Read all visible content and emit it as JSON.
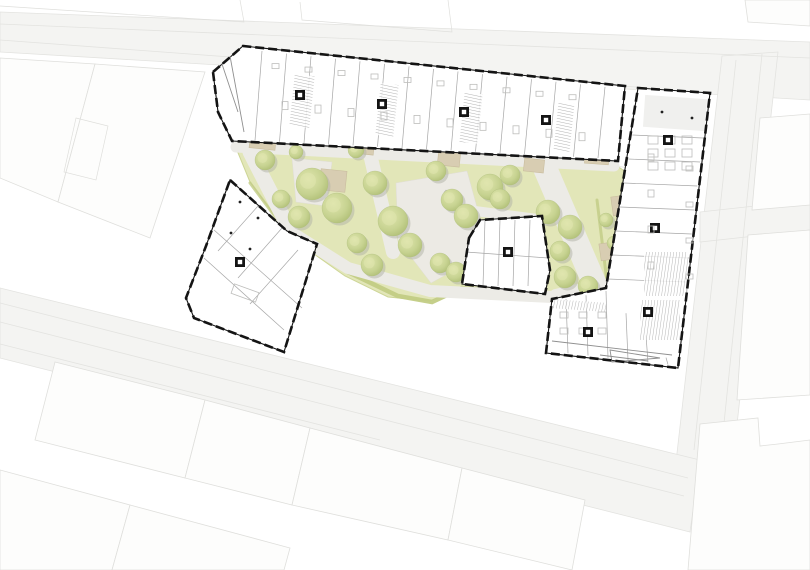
{
  "app": {
    "type": "architectural-site-plan",
    "description": "Ground-floor site plan of a perimeter housing block with green courtyard, trees and surrounding streets",
    "visible_text_labels": []
  },
  "palette": {
    "street_fill": "#f4f4f2",
    "street_line": "#e3e3e0",
    "context_fill": "#fdfdfc",
    "context_line": "#dfdfdc",
    "green_fill": "#e2e6b8",
    "green_rim": "#cdd596",
    "green_edge": "#c2cc84",
    "path_fill": "#ecebe6",
    "plaza_fill": "#eceae4",
    "terrace_fill": "#d8cdb2",
    "terrace_line": "#c9bd9e",
    "tree_light": "#e0e6ae",
    "tree_mid": "#c3d08b",
    "tree_dark": "#aebd74",
    "tree_shadow": "#b0b2a6",
    "wall": "#141414"
  },
  "site": {
    "trees": [
      {
        "x": 265,
        "y": 160,
        "r": 10
      },
      {
        "x": 296,
        "y": 152,
        "r": 7
      },
      {
        "x": 312,
        "y": 184,
        "r": 16
      },
      {
        "x": 337,
        "y": 208,
        "r": 15
      },
      {
        "x": 299,
        "y": 217,
        "r": 11
      },
      {
        "x": 281,
        "y": 199,
        "r": 9
      },
      {
        "x": 356,
        "y": 150,
        "r": 8
      },
      {
        "x": 375,
        "y": 183,
        "r": 12
      },
      {
        "x": 393,
        "y": 221,
        "r": 15
      },
      {
        "x": 410,
        "y": 245,
        "r": 12
      },
      {
        "x": 357,
        "y": 243,
        "r": 10
      },
      {
        "x": 372,
        "y": 265,
        "r": 11
      },
      {
        "x": 436,
        "y": 171,
        "r": 10
      },
      {
        "x": 452,
        "y": 200,
        "r": 11
      },
      {
        "x": 466,
        "y": 216,
        "r": 12
      },
      {
        "x": 440,
        "y": 263,
        "r": 10
      },
      {
        "x": 456,
        "y": 272,
        "r": 10
      },
      {
        "x": 490,
        "y": 187,
        "r": 13
      },
      {
        "x": 510,
        "y": 175,
        "r": 10
      },
      {
        "x": 500,
        "y": 199,
        "r": 10
      },
      {
        "x": 548,
        "y": 212,
        "r": 12
      },
      {
        "x": 570,
        "y": 227,
        "r": 12
      },
      {
        "x": 560,
        "y": 251,
        "r": 10
      },
      {
        "x": 565,
        "y": 277,
        "r": 11
      },
      {
        "x": 588,
        "y": 286,
        "r": 10
      },
      {
        "x": 614,
        "y": 243,
        "r": 7
      },
      {
        "x": 606,
        "y": 220,
        "r": 7
      }
    ],
    "terraces": [
      {
        "x": 250,
        "y": 130,
        "w": 26,
        "h": 19,
        "a": 6
      },
      {
        "x": 320,
        "y": 170,
        "w": 26,
        "h": 21,
        "a": 6
      },
      {
        "x": 352,
        "y": 139,
        "w": 22,
        "h": 15,
        "a": 6
      },
      {
        "x": 438,
        "y": 151,
        "w": 22,
        "h": 15,
        "a": 6
      },
      {
        "x": 524,
        "y": 159,
        "w": 20,
        "h": 13,
        "a": 6
      },
      {
        "x": 585,
        "y": 147,
        "w": 24,
        "h": 17,
        "a": 4
      },
      {
        "x": 612,
        "y": 196,
        "w": 15,
        "h": 19,
        "a": -8
      },
      {
        "x": 600,
        "y": 243,
        "w": 13,
        "h": 17,
        "a": -8
      },
      {
        "x": 560,
        "y": 303,
        "w": 20,
        "h": 12,
        "a": 5
      },
      {
        "x": 468,
        "y": 240,
        "w": 12,
        "h": 16,
        "a": -6
      }
    ],
    "benches": [
      {
        "x": 400,
        "y": 214,
        "w": 9,
        "h": 3,
        "a": 80
      },
      {
        "x": 406,
        "y": 238,
        "w": 9,
        "h": 3,
        "a": 5
      },
      {
        "x": 446,
        "y": 190,
        "w": 8,
        "h": 3,
        "a": 40
      }
    ]
  }
}
